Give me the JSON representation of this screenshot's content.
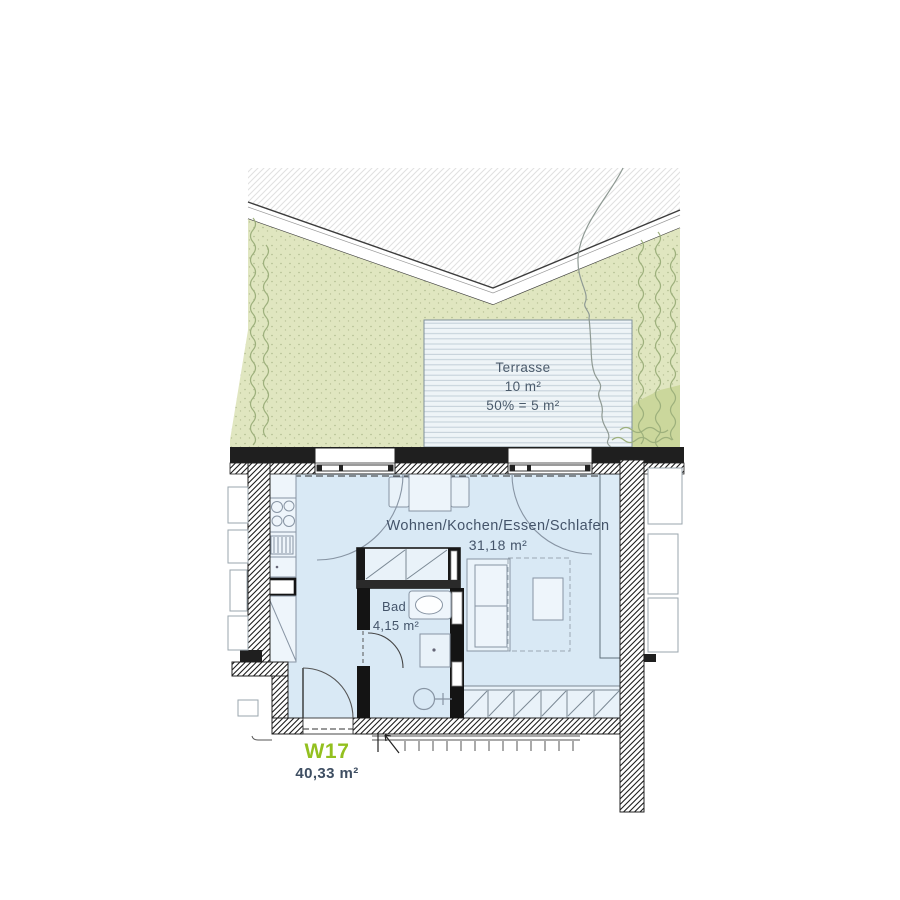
{
  "unit": {
    "id": "W17",
    "area": "40,33 m²"
  },
  "rooms": {
    "terrace": {
      "name": "Terrasse",
      "area": "10 m²",
      "note": "50% = 5 m²"
    },
    "living": {
      "name": "Wohnen/Kochen/Essen/Schlafen",
      "area": "31,18 m²"
    },
    "bath": {
      "name": "Bad",
      "area": "4,15 m²"
    }
  },
  "colors": {
    "accent": "#93c01f",
    "label": "#44546a",
    "floor": "#d9e9f5",
    "garden": "#e0e6c0",
    "deck": "#eef4f7",
    "wall_dark": "#1f1f1f"
  }
}
